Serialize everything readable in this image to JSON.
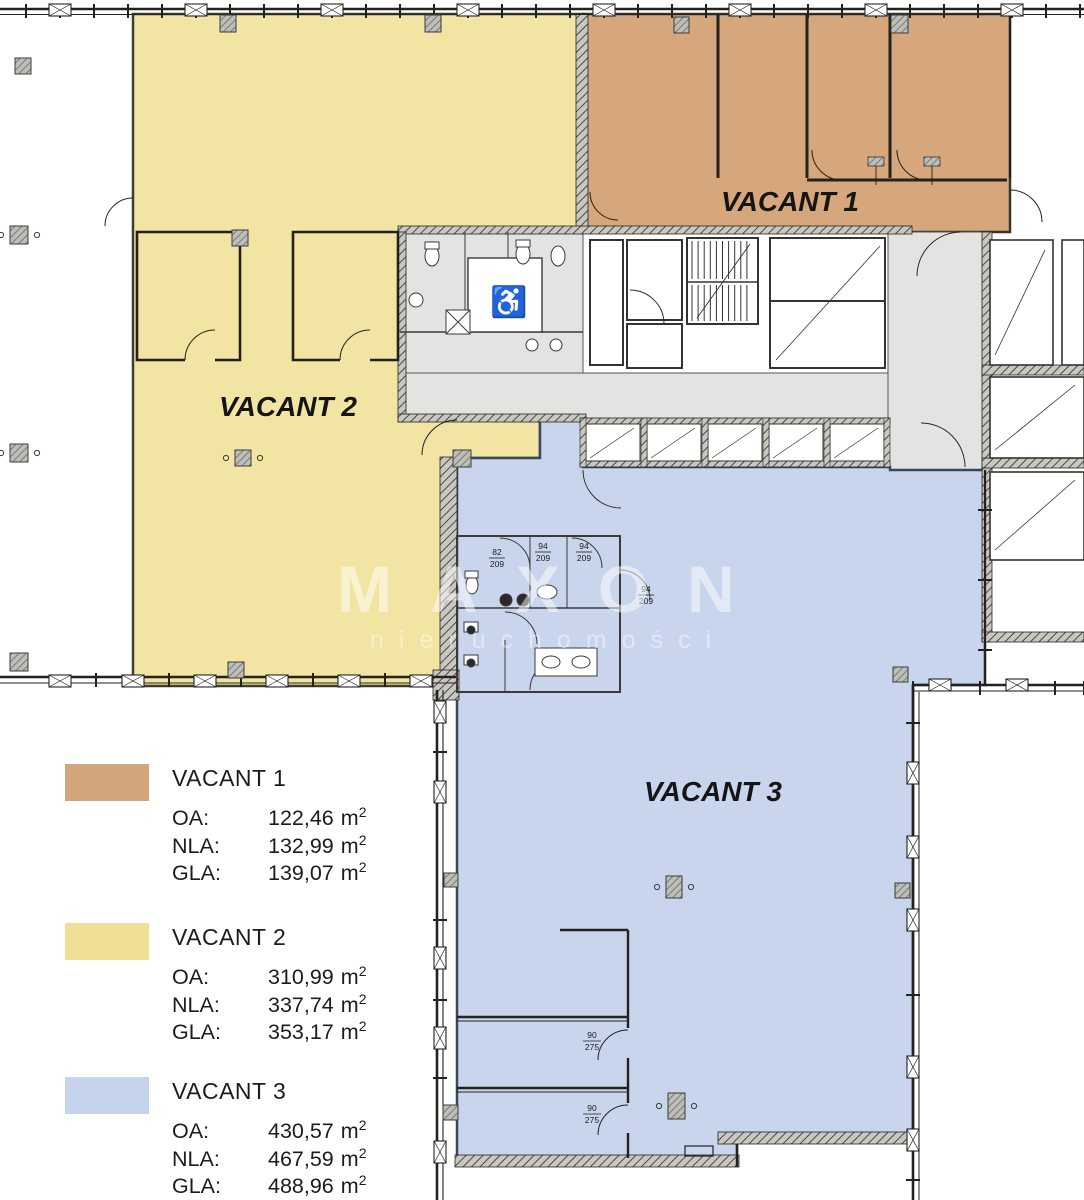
{
  "plan": {
    "area_labels": [
      {
        "text": "VACANT 1"
      },
      {
        "text": "VACANT 2"
      },
      {
        "text": "VACANT 3"
      }
    ],
    "watermark": {
      "brand": "MAXON",
      "tagline": "nieruchomości"
    },
    "door_labels": [
      {
        "w": "90",
        "h": "275"
      },
      {
        "w": "90",
        "h": "275"
      },
      {
        "w": "82",
        "h": "209"
      },
      {
        "w": "94",
        "h": "209"
      },
      {
        "w": "94",
        "h": "209"
      },
      {
        "w": "94",
        "h": "209"
      }
    ],
    "accessible_wc_icon": "wheelchair-icon"
  },
  "legend": {
    "unit": "m",
    "unit_sup": "2",
    "entries": [
      {
        "name": "VACANT 1",
        "color": "#d3a57d",
        "rows": [
          {
            "label": "OA:",
            "value": "122,46"
          },
          {
            "label": "NLA:",
            "value": "132,99"
          },
          {
            "label": "GLA:",
            "value": "139,07"
          }
        ]
      },
      {
        "name": "VACANT 2",
        "color": "#f0e096",
        "rows": [
          {
            "label": "OA:",
            "value": "310,99"
          },
          {
            "label": "NLA:",
            "value": "337,74"
          },
          {
            "label": "GLA:",
            "value": "353,17"
          }
        ]
      },
      {
        "name": "VACANT 3",
        "color": "#c6d3ec",
        "rows": [
          {
            "label": "OA:",
            "value": "430,57"
          },
          {
            "label": "NLA:",
            "value": "467,59"
          },
          {
            "label": "GLA:",
            "value": "488,96"
          }
        ]
      }
    ]
  },
  "colors": {
    "vacant1_fill": "#d6a77c",
    "vacant2_fill": "#f2e5a3",
    "vacant3_fill": "#c8d5ec",
    "corridor_fill": "#e3e3e1",
    "wall": "#23221f",
    "watermark": "#ffffff"
  }
}
